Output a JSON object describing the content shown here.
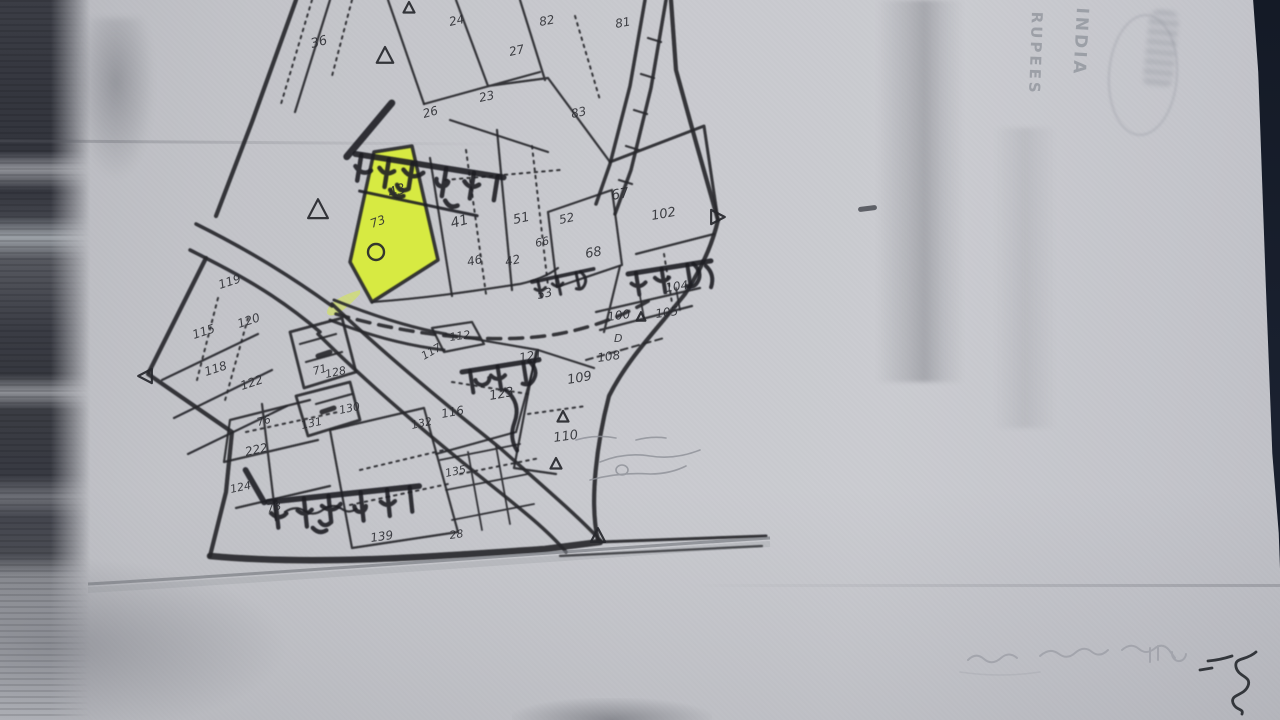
{
  "surface": {
    "document_type": "Photocopy of a hand-drawn village cadastral map on Indian stamp paper, one plot highlighted with yellow marker",
    "paper_color": "#c6c7cb",
    "ink_color": "#26272c",
    "highlight_color": "#d9ef2f",
    "background_color": "#141a26"
  },
  "stamp": {
    "word_rupees": "RUPEES",
    "word_india": "INDIA"
  },
  "map": {
    "village_labels": [
      {
        "id": "gohan-top",
        "text": "गोहान",
        "translit": "Gohan"
      },
      {
        "id": "damat-right",
        "text": "दमट",
        "translit": "Damat"
      },
      {
        "id": "damat-small",
        "text": "दमट",
        "translit": "Damat"
      },
      {
        "id": "damat-mid",
        "text": "दमट",
        "translit": "Damat"
      },
      {
        "id": "gohan-bottom",
        "text": "गोहान",
        "translit": "Gohan"
      }
    ],
    "highlighted_plot": {
      "number": "४३",
      "circle_mark": {
        "x": 376,
        "y": 252,
        "r": 8
      }
    },
    "plot_numbers": [
      {
        "t": "३६",
        "x": 312,
        "y": 48,
        "r": -15,
        "s": 13
      },
      {
        "t": "२४",
        "x": 450,
        "y": 26,
        "r": -12,
        "s": 12
      },
      {
        "t": "२७",
        "x": 510,
        "y": 56,
        "r": -12,
        "s": 12
      },
      {
        "t": "८२",
        "x": 540,
        "y": 26,
        "r": -10,
        "s": 12
      },
      {
        "t": "८१",
        "x": 616,
        "y": 28,
        "r": -10,
        "s": 12
      },
      {
        "t": "८३",
        "x": 572,
        "y": 118,
        "r": -12,
        "s": 12
      },
      {
        "t": "२३",
        "x": 480,
        "y": 102,
        "r": -12,
        "s": 12
      },
      {
        "t": "२६",
        "x": 424,
        "y": 118,
        "r": -15,
        "s": 12
      },
      {
        "t": "४३",
        "x": 390,
        "y": 198,
        "r": -20,
        "s": 14
      },
      {
        "t": "७३",
        "x": 372,
        "y": 228,
        "r": -20,
        "s": 12
      },
      {
        "t": "४१",
        "x": 452,
        "y": 228,
        "r": -15,
        "s": 14
      },
      {
        "t": "५१",
        "x": 514,
        "y": 224,
        "r": -12,
        "s": 13
      },
      {
        "t": "५२",
        "x": 560,
        "y": 224,
        "r": -12,
        "s": 12
      },
      {
        "t": "६६",
        "x": 536,
        "y": 247,
        "r": -12,
        "s": 11
      },
      {
        "t": "४६",
        "x": 468,
        "y": 266,
        "r": -12,
        "s": 12
      },
      {
        "t": "४२",
        "x": 506,
        "y": 266,
        "r": -12,
        "s": 12
      },
      {
        "t": "५३",
        "x": 538,
        "y": 299,
        "r": -12,
        "s": 12
      },
      {
        "t": "६७",
        "x": 612,
        "y": 200,
        "r": -10,
        "s": 14
      },
      {
        "t": "१०२",
        "x": 652,
        "y": 220,
        "r": -10,
        "s": 13
      },
      {
        "t": "६८",
        "x": 586,
        "y": 258,
        "r": -10,
        "s": 13
      },
      {
        "t": "१०४",
        "x": 666,
        "y": 292,
        "r": -8,
        "s": 12
      },
      {
        "t": "१००",
        "x": 608,
        "y": 321,
        "r": -8,
        "s": 12
      },
      {
        "t": "१०५",
        "x": 656,
        "y": 318,
        "r": -8,
        "s": 12
      },
      {
        "t": "D",
        "x": 614,
        "y": 342,
        "r": 0,
        "s": 11
      },
      {
        "t": "१०८",
        "x": 598,
        "y": 362,
        "r": -8,
        "s": 12
      },
      {
        "t": "१०९",
        "x": 568,
        "y": 384,
        "r": -10,
        "s": 13
      },
      {
        "t": "११०",
        "x": 554,
        "y": 442,
        "r": -8,
        "s": 13
      },
      {
        "t": "११२",
        "x": 450,
        "y": 341,
        "r": -8,
        "s": 11
      },
      {
        "t": "११७",
        "x": 424,
        "y": 360,
        "r": -30,
        "s": 11
      },
      {
        "t": "१२१",
        "x": 520,
        "y": 362,
        "r": -10,
        "s": 12
      },
      {
        "t": "१२३",
        "x": 490,
        "y": 400,
        "r": -10,
        "s": 13
      },
      {
        "t": "११६",
        "x": 442,
        "y": 418,
        "r": -10,
        "s": 12
      },
      {
        "t": "११९",
        "x": 220,
        "y": 289,
        "r": -18,
        "s": 12
      },
      {
        "t": "१२०",
        "x": 239,
        "y": 328,
        "r": -18,
        "s": 12
      },
      {
        "t": "११५",
        "x": 194,
        "y": 339,
        "r": -18,
        "s": 12
      },
      {
        "t": "११८",
        "x": 206,
        "y": 376,
        "r": -18,
        "s": 12
      },
      {
        "t": "१२२",
        "x": 242,
        "y": 390,
        "r": -18,
        "s": 12
      },
      {
        "t": "७१",
        "x": 314,
        "y": 375,
        "r": -15,
        "s": 11
      },
      {
        "t": "७६",
        "x": 258,
        "y": 426,
        "r": -15,
        "s": 11
      },
      {
        "t": "१२८",
        "x": 326,
        "y": 378,
        "r": -12,
        "s": 11
      },
      {
        "t": "१३०",
        "x": 340,
        "y": 414,
        "r": -12,
        "s": 11
      },
      {
        "t": "१३१",
        "x": 302,
        "y": 429,
        "r": -12,
        "s": 11
      },
      {
        "t": "१३२",
        "x": 412,
        "y": 429,
        "r": -12,
        "s": 11
      },
      {
        "t": "१३५",
        "x": 446,
        "y": 477,
        "r": -12,
        "s": 11
      },
      {
        "t": "२२२",
        "x": 246,
        "y": 456,
        "r": -12,
        "s": 12
      },
      {
        "t": "१२४",
        "x": 231,
        "y": 493,
        "r": -12,
        "s": 11
      },
      {
        "t": "७८",
        "x": 268,
        "y": 512,
        "r": -12,
        "s": 11
      },
      {
        "t": "१३९",
        "x": 371,
        "y": 542,
        "r": -8,
        "s": 12
      },
      {
        "t": "२८",
        "x": 450,
        "y": 539,
        "r": -8,
        "s": 11
      }
    ],
    "survey_markers": [
      {
        "x": 385,
        "y": 56,
        "s": 1.5
      },
      {
        "x": 409,
        "y": 8,
        "s": 1
      },
      {
        "x": 318,
        "y": 210,
        "s": 1.8
      },
      {
        "x": 146,
        "y": 376,
        "s": 1.3,
        "rot": -90
      },
      {
        "x": 598,
        "y": 536,
        "s": 1.3
      },
      {
        "x": 717,
        "y": 217,
        "s": 1.3,
        "rot": 90
      },
      {
        "x": 563,
        "y": 417,
        "s": 1
      },
      {
        "x": 556,
        "y": 464,
        "s": 1
      },
      {
        "x": 641,
        "y": 317,
        "s": 0.8
      }
    ]
  }
}
